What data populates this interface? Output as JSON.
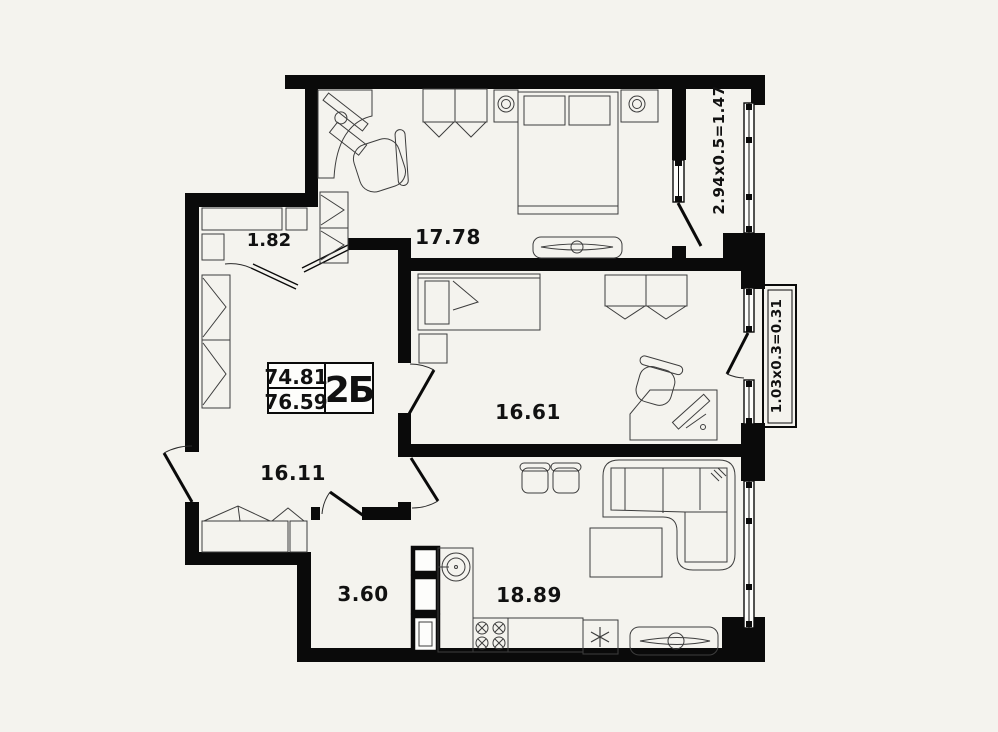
{
  "plan": {
    "title_block": {
      "value_top": "74.81",
      "value_bottom": "76.59",
      "unit_label": "2Б"
    },
    "rooms": {
      "closet": "1.82",
      "bedroom": "17.78",
      "bedroom2": "16.61",
      "hall": "16.11",
      "bathroom": "3.60",
      "kitchen_living": "18.89"
    },
    "dimensions": {
      "balcony": "2.94x0.5=1.47",
      "french_balcony": "1.03x0.3=0.31"
    },
    "colors": {
      "background": "#f4f3ee",
      "walls": "#0a0a0a",
      "furniture_lines": "#3d3d3d"
    }
  }
}
